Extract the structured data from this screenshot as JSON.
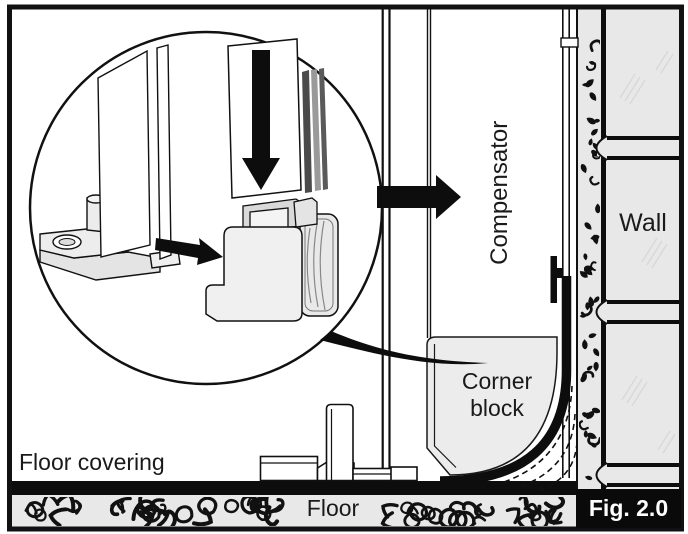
{
  "figure": {
    "caption": "Fig. 2.0",
    "labels": {
      "compensator": "Compensator",
      "wall": "Wall",
      "corner_block": "Corner\nblock",
      "floor_covering": "Floor covering",
      "floor": "Floor"
    },
    "colors": {
      "line": "#111111",
      "material_fill": "#e8e8e8",
      "background": "#ffffff",
      "caption_bg": "#0a0a0a",
      "caption_text": "#ffffff"
    },
    "icons": {
      "insert_arrow": "down-arrow",
      "slide_arrow": "right-arrow",
      "fit_arrow": "right-arrow",
      "detail_pointer": "curved-swoosh-pointer"
    }
  }
}
